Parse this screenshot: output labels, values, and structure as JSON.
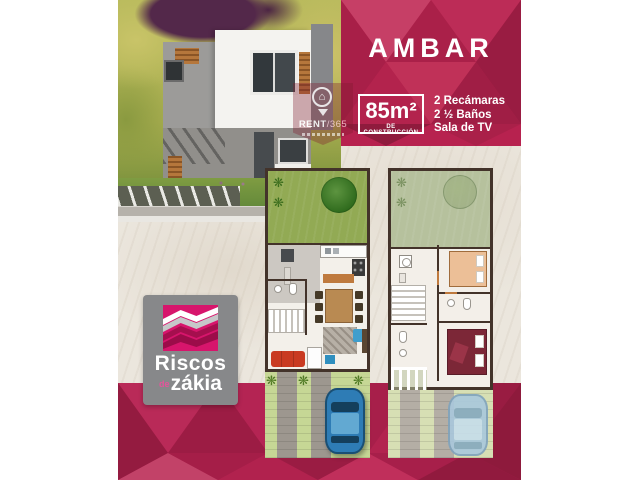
{
  "header": {
    "title": "AMBAR",
    "area": {
      "value": "85m²",
      "label": "DE CONSTRUCCIÓN"
    },
    "features": [
      "2 Recámaras",
      "2 ½ Baños",
      "Sala de TV"
    ]
  },
  "watermark": {
    "brand_name": "RENT",
    "brand_suffix": "/365"
  },
  "logo": {
    "line1": "Riscos",
    "prefix": "de",
    "line2": "zákia"
  },
  "glyphs": {
    "plant": "❋",
    "house": "⌂"
  },
  "colors": {
    "accent_pink": "#b7224f",
    "accent_pink_dark": "#9c1c44",
    "logo_magenta": "#d7156c",
    "background_beige": "#ebe6dd",
    "garden_green": "#92aa54",
    "yard_green": "#c6d795",
    "car_blue": "#2e7cb5",
    "logo_gray": "#87888a",
    "sofa_red": "#c93a21",
    "master_bed_red": "#7c2737"
  }
}
